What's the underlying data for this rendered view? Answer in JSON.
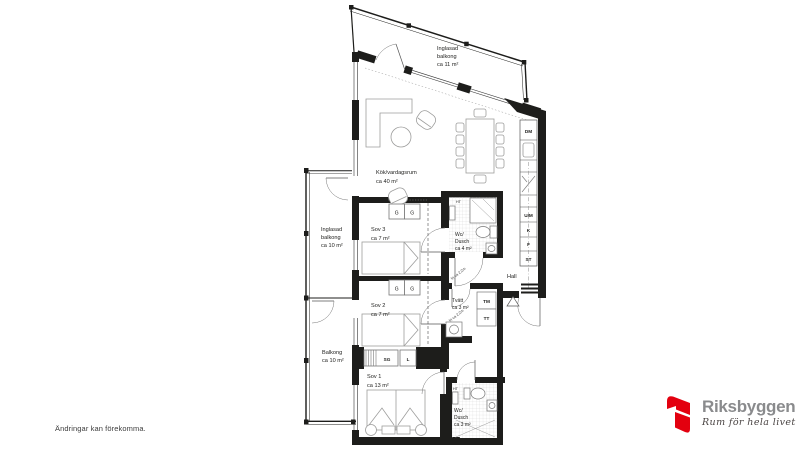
{
  "footnote": "Ändringar kan förekomma.",
  "brand": {
    "name": "Riksbyggen",
    "tagline": "Rum för hela livet"
  },
  "floorplan": {
    "rooms": {
      "glazed_balcony_top": {
        "l1": "Inglasad",
        "l2": "balkong",
        "l3": "ca 11 m²"
      },
      "kitchen_living": {
        "l1": "Kök/vardagsrum",
        "l2": "ca 40 m²"
      },
      "glazed_balcony_left": {
        "l1": "Inglasad",
        "l2": "balkong",
        "l3": "ca 10 m²"
      },
      "balcony_left": {
        "l1": "Balkong",
        "l2": "ca 10 m²"
      },
      "bedroom3": {
        "l1": "Sov 3",
        "l2": "ca 7 m²"
      },
      "bedroom2": {
        "l1": "Sov 2",
        "l2": "ca 7 m²"
      },
      "bedroom1": {
        "l1": "Sov 1",
        "l2": "ca 13 m²"
      },
      "bathroom_large": {
        "l1": "Wc/",
        "l2": "Dusch",
        "l3": "ca 4 m²"
      },
      "bathroom_small": {
        "l1": "Wc/",
        "l2": "Dusch",
        "l3": "ca 3 m²"
      },
      "laundry": {
        "l1": "Tvätt",
        "l2": "ca 3 m²"
      },
      "hall": {
        "l1": "Hall"
      }
    },
    "appliances": {
      "dm": "DM",
      "um": "U/M",
      "k": "K",
      "f": "F",
      "st": "ST",
      "tm": "TM",
      "tt": "TT",
      "sg": "SG",
      "l": "L",
      "g": "G",
      "ht": "HT"
    },
    "annotations": {
      "free1": "fri ca 2,2m",
      "free2": "fri ca 2,2m"
    }
  },
  "colors": {
    "wall": "#1d1d1b",
    "furniture": "#9d9d9c",
    "brand_red": "#e3000f",
    "brand_gray": "#8a8b8d"
  }
}
